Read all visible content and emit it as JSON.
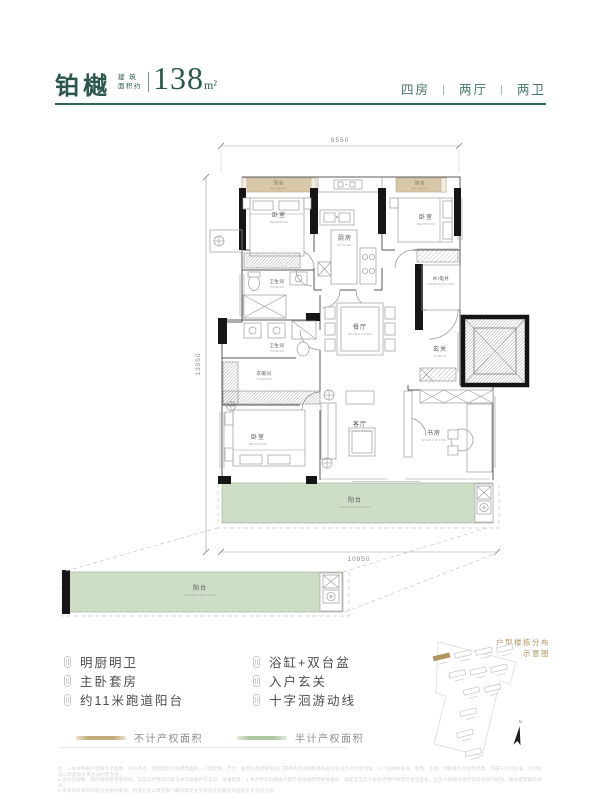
{
  "header": {
    "title": "铂樾",
    "area_label_top": "建 筑",
    "area_label_bottom": "面积约",
    "area_value": "138",
    "area_unit": "m²",
    "spec_rooms": "四房",
    "spec_sep": "丨",
    "spec_halls": "两厅",
    "spec_baths": "两卫"
  },
  "plan": {
    "dim_top": "9550",
    "dim_left": "13950",
    "dim_bottom": "10950",
    "rooms": {
      "bay": {
        "cn": "飘窗",
        "en": "BAY WINDOW"
      },
      "bedroom": {
        "cn": "卧室",
        "en": "BEDROOM"
      },
      "kitchen": {
        "cn": "厨房",
        "en": "KITCHEN"
      },
      "bath": {
        "cn": "卫生间",
        "en": "BATHROOM"
      },
      "well": {
        "cn": "水/电井",
        "en": "WATER/ELECTRIC WELL"
      },
      "dining": {
        "cn": "餐厅",
        "en": "DINING ROOM"
      },
      "porch": {
        "cn": "玄关",
        "en": "PORCH"
      },
      "cloak": {
        "cn": "衣帽间",
        "en": "CLOAKROOM"
      },
      "living": {
        "cn": "客厅",
        "en": "LIVING ROOM"
      },
      "study": {
        "cn": "书房",
        "en": "STUDY ROOM"
      },
      "balcony": {
        "cn": "阳台",
        "en": "GARDEN BALCONY"
      }
    }
  },
  "features": {
    "left": [
      "明厨明卫",
      "主卧套房",
      "约11米跑道阳台"
    ],
    "right": [
      "浴缸+双台盆",
      "入户玄关",
      "十字洄游动线"
    ]
  },
  "legend": {
    "item1": {
      "label": "不计产权面积",
      "color": "#c3ab7c"
    },
    "item2": {
      "label": "半计产权面积",
      "color": "#aec79f"
    }
  },
  "siteplan": {
    "title1": "户型楼栋分布",
    "title2": "示意图",
    "north": "N"
  },
  "disclaimer": {
    "line1": "注：1.本页所载户型图为示意图，仅供参考，所示面积均为建筑面积，户型结构、尺寸、面积以政府相关部门最终审定的图纸及商品房买卖合同约定为准；2.户型图中家具、家电、洁具、绿植等仅为装饰示意，不属于交付标准，交付标准以商品房买卖合同约定为准；",
    "line2": "3.因设计调整、政府规划变更等原因，实际交付情况可能与本示意图存在差异，敬请留意；4.本宣传资料相关内容不排除因政府相关规划、规定及出卖人未能控制的原因而发生变化，出卖人保留对宣传资料修改的权利，敬请留意最新资料；",
    "line3": "5.本资料所发布内容仅为要约邀请，相关信息以政府部门最终审定文件及双方签署的商品房买卖合同为准。"
  },
  "colors": {
    "accent_teal": "#2b584e",
    "divider_teal": "#30635a",
    "bay_window_tan": "#d7c8a9",
    "balcony_green": "#cdddc6",
    "legend_tan": "#c3ab7c",
    "legend_green": "#aec79f",
    "siteplan_gold": "#b2955e"
  }
}
